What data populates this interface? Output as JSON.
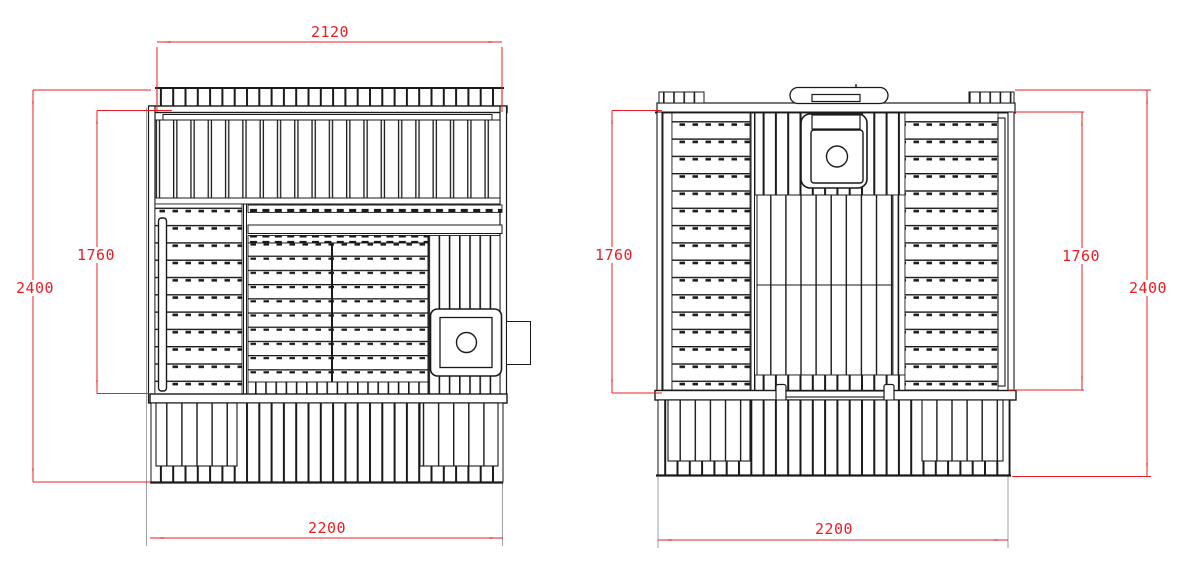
{
  "page": {
    "background": "#ffffff"
  },
  "drawing": {
    "line_color": "#1a1a1a",
    "dimension_color": "#ed1c24",
    "views": {
      "left": {
        "dims": {
          "top_width": "2120",
          "overall_height": "2400",
          "wall_height": "1760",
          "overall_width": "2200"
        }
      },
      "right": {
        "dims": {
          "left_wall_height": "1760",
          "right_wall_height": "1760",
          "overall_height": "2400",
          "overall_width": "2200"
        }
      }
    }
  }
}
